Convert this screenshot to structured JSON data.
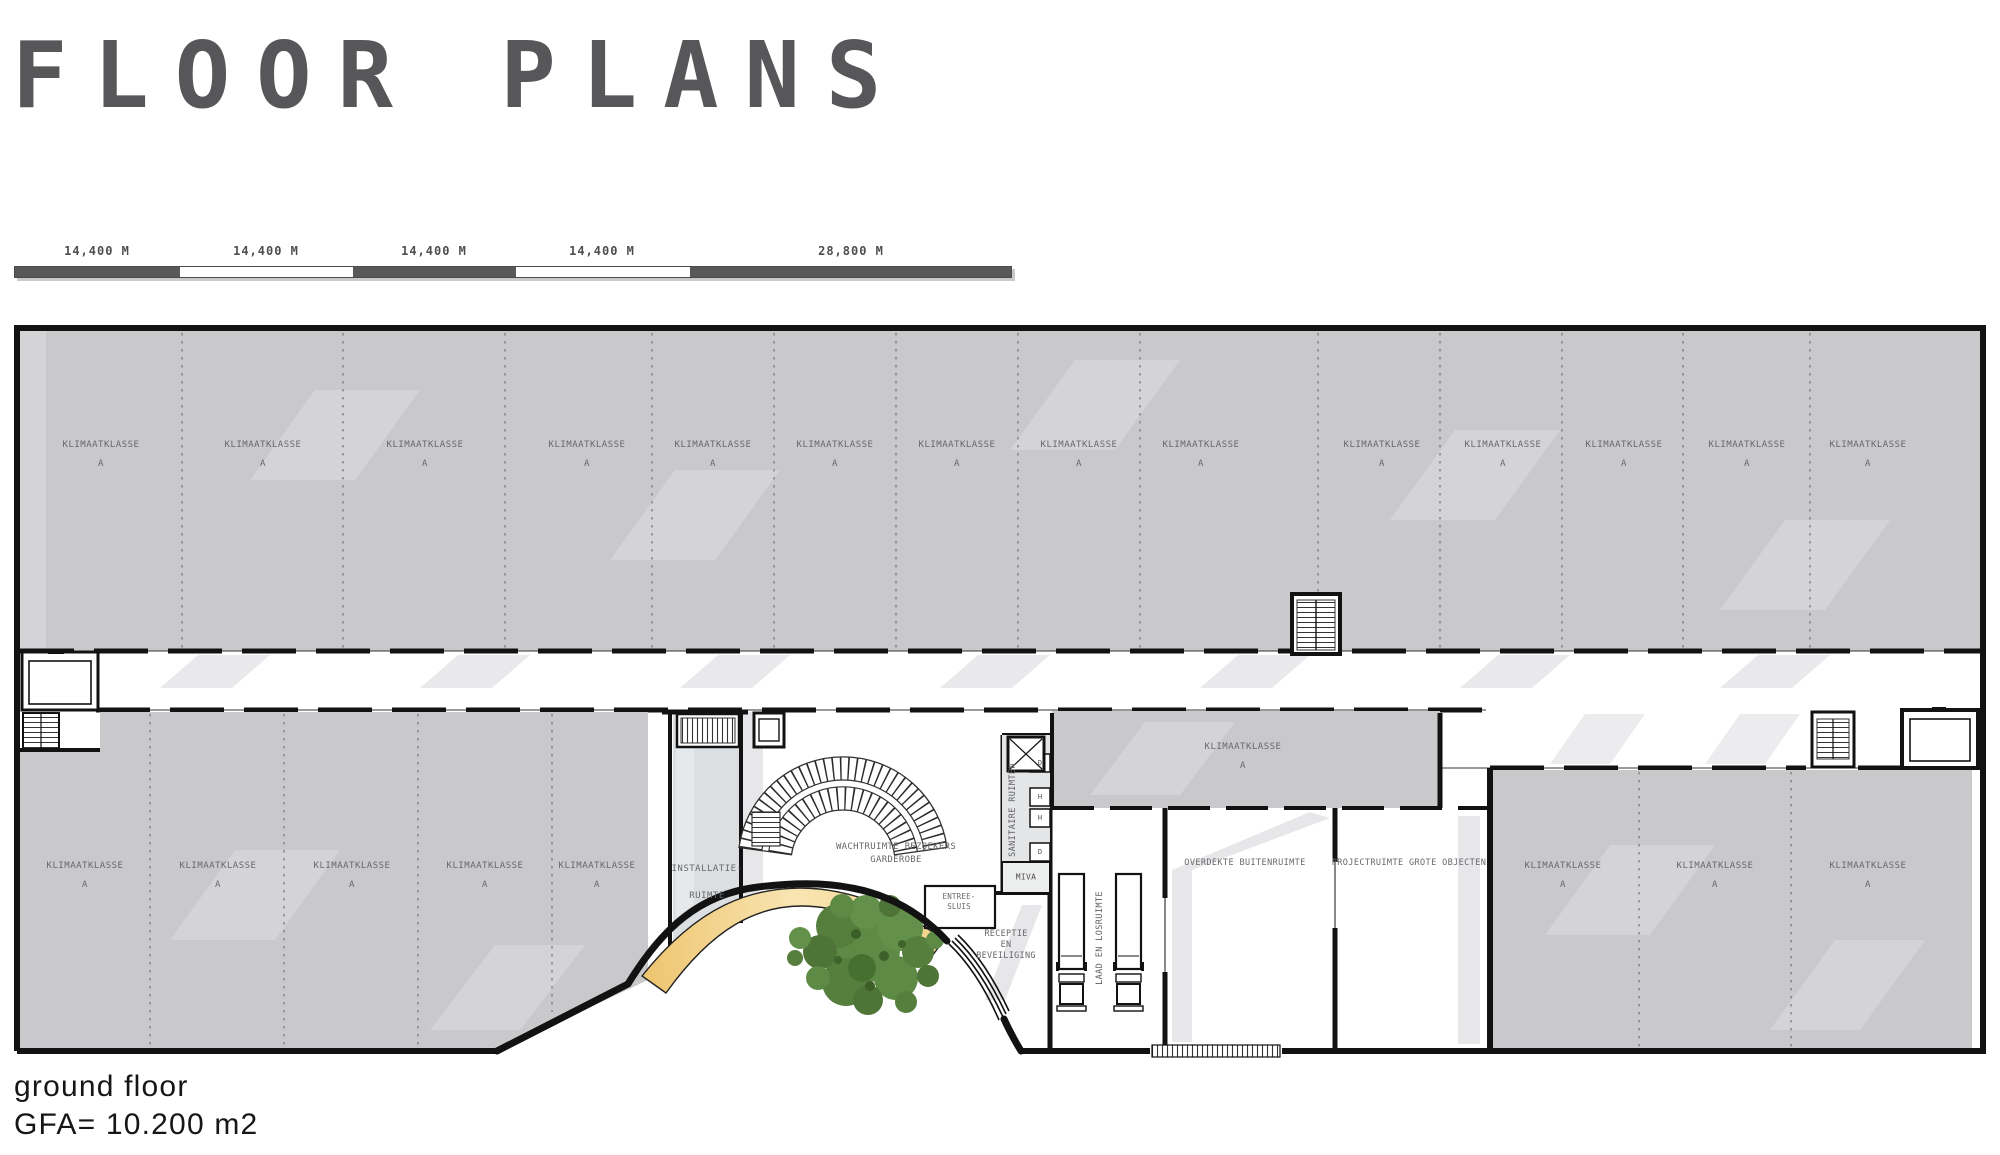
{
  "title": "FLOOR PLANS",
  "scale_bar": {
    "labels": [
      "14,400 M",
      "14,400 M",
      "14,400 M",
      "14,400 M",
      "28,800 M"
    ]
  },
  "plan": {
    "rooms": {
      "klimaatklasse": {
        "line1": "KLIMAATKLASSE",
        "line2": "A"
      },
      "installatie": {
        "line1": "INSTALLATIE-",
        "line2": "RUIMTE"
      },
      "wachtruimte": {
        "line1": "WACHTRUIMTE BEZOEKERS",
        "line2": "GARDEROBE"
      },
      "entree_sluis": {
        "line1": "ENTREE-",
        "line2": "SLUIS"
      },
      "receptie": {
        "line1": "RECEPTIE",
        "line2": "EN",
        "line3": "BEVEILIGING"
      },
      "sanitaire": {
        "label": "SANITAIRE RUIMTEN",
        "cells": [
          "D",
          "H",
          "H",
          "D"
        ],
        "miva": "MIVA"
      },
      "laad": {
        "label": "LAAD EN LOSRUIMTE"
      },
      "overdekte": {
        "label": "OVERDEKTE BUITENRUIMTE"
      },
      "projectruimte": {
        "label": "PROJECTRUIMTE GROTE OBJECTEN"
      }
    }
  },
  "footer": {
    "line1": "ground floor",
    "line2": "GFA= 10.200 m2"
  },
  "colors": {
    "room_gray": "#c9c9cb",
    "service_gray": "#dcdfe2",
    "canopy_yellow": "#f3d48a",
    "tree_green": "#5d8a45",
    "wall_black": "#121212",
    "label_gray": "#68686c",
    "bar_dark": "#58585a"
  }
}
